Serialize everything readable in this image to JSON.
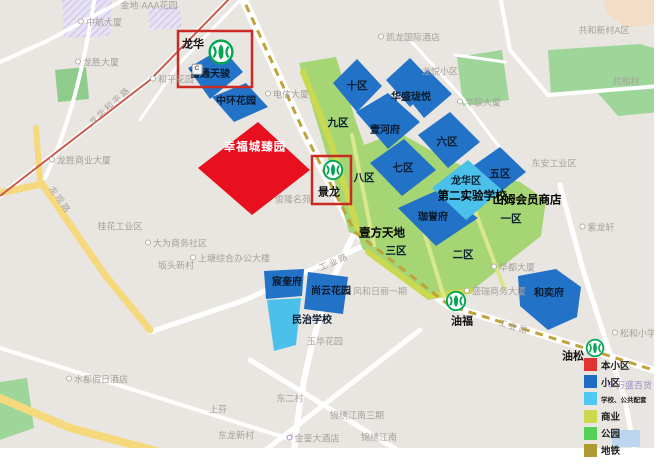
{
  "map": {
    "highlight": {
      "label": "幸福城臻园"
    },
    "stations": [
      {
        "id": "longhua",
        "label": "龙华",
        "boxed": true,
        "exit_badge": "C"
      },
      {
        "id": "jinglong",
        "label": "景龙",
        "boxed": true
      },
      {
        "id": "youfu",
        "label": "油福",
        "boxed": false
      },
      {
        "id": "yousong",
        "label": "油松",
        "boxed": false
      }
    ],
    "zones": [
      {
        "id": "zone10",
        "label": "十区"
      },
      {
        "id": "zone9",
        "label": "九区"
      },
      {
        "id": "zone8",
        "label": "八区"
      },
      {
        "id": "zone7",
        "label": "七区"
      },
      {
        "id": "zone6",
        "label": "六区"
      },
      {
        "id": "zone5",
        "label": "五区"
      },
      {
        "id": "zone3",
        "label": "三区"
      },
      {
        "id": "zone2",
        "label": "二区"
      },
      {
        "id": "zone1",
        "label": "一区"
      }
    ],
    "communities": [
      {
        "id": "futongtianjun",
        "label": "富通天骏"
      },
      {
        "id": "zhonghuan",
        "label": "中环花园"
      },
      {
        "id": "huasheng",
        "label": "华盛珑悦"
      },
      {
        "id": "yihefu",
        "label": "壹河府"
      },
      {
        "id": "jiayufu",
        "label": "珈誉府"
      },
      {
        "id": "shangyun",
        "label": "尚云花园"
      },
      {
        "id": "chenkuifu",
        "label": "宸奎府"
      },
      {
        "id": "heyifu",
        "label": "和奕府"
      }
    ],
    "landmarks": [
      {
        "id": "school2_district",
        "label": "龙华区"
      },
      {
        "id": "school2",
        "label": "第二实验学校"
      },
      {
        "id": "sam",
        "label": "山姆会员商店"
      },
      {
        "id": "yifang",
        "label": "壹方天地"
      },
      {
        "id": "minzhi",
        "label": "民治学校"
      }
    ],
    "road_labels": [
      {
        "id": "gongyelu1",
        "label": "工业路"
      },
      {
        "id": "gongyelu2",
        "label": "工业路"
      },
      {
        "id": "hepinglu",
        "label": "龙华和平路"
      },
      {
        "id": "longguanlu",
        "label": "龙观路"
      }
    ],
    "background_labels": [
      {
        "id": "jindiaaa",
        "label": "金地·AAA花园",
        "poi": false
      },
      {
        "id": "zhonghang",
        "label": "中航大厦",
        "poi": true
      },
      {
        "id": "longsheng_bldg",
        "label": "龙胜大厦",
        "poi": true
      },
      {
        "id": "heping_garden",
        "label": "和平花园",
        "poi": true
      },
      {
        "id": "kailong",
        "label": "凯龙国际酒店",
        "poi": true
      },
      {
        "id": "gonghe_a",
        "label": "共和新村A区",
        "poi": false
      },
      {
        "id": "longyue",
        "label": "龙悦小区",
        "poi": false
      },
      {
        "id": "hualian",
        "label": "华联大厦",
        "poi": true
      },
      {
        "id": "gonghecun",
        "label": "共和村",
        "poi": false
      },
      {
        "id": "dianxin",
        "label": "电信大厦",
        "poi": true
      },
      {
        "id": "longsheng_biz",
        "label": "龙胜商业大厦",
        "poi": true
      },
      {
        "id": "guihua_ind",
        "label": "桂花工业区",
        "poi": false
      },
      {
        "id": "junlong",
        "label": "俊隆名苑",
        "poi": false
      },
      {
        "id": "dawei",
        "label": "大为商务社区",
        "poi": true
      },
      {
        "id": "shangtang",
        "label": "上塘综合办公大楼",
        "poi": true
      },
      {
        "id": "bantou",
        "label": "坂头新村",
        "poi": false
      },
      {
        "id": "dongan",
        "label": "东安工业区",
        "poi": false
      },
      {
        "id": "shengrui",
        "label": "盛瑞商务大厦",
        "poi": true
      },
      {
        "id": "fenghe",
        "label": "风和日丽一期",
        "poi": false
      },
      {
        "id": "yuhua",
        "label": "玉华花园",
        "poi": false
      },
      {
        "id": "shuidu",
        "label": "水都假日酒店",
        "poi": true
      },
      {
        "id": "shangfen",
        "label": "上芬",
        "poi": false
      },
      {
        "id": "dongercun",
        "label": "东二村",
        "poi": false
      },
      {
        "id": "donglong",
        "label": "东龙新村",
        "poi": false
      },
      {
        "id": "jinluan",
        "label": "金銮大酒店",
        "poi": true,
        "pin": "purple"
      },
      {
        "id": "jinxiu3",
        "label": "锦绣江南三期",
        "poi": false
      },
      {
        "id": "jinxiu",
        "label": "锦绣江南",
        "poi": false
      },
      {
        "id": "wansheng",
        "label": "万盛百货",
        "poi": true,
        "pin": "purple",
        "purple": true
      },
      {
        "id": "songhe",
        "label": "松和小学",
        "poi": true
      },
      {
        "id": "zilong",
        "label": "紫龙轩",
        "poi": true
      },
      {
        "id": "huadu",
        "label": "华都大厦",
        "poi": true
      }
    ],
    "legend": {
      "items": [
        {
          "id": "self",
          "label": "本小区",
          "color": "#e23333"
        },
        {
          "id": "community",
          "label": "小区",
          "color": "#1f6cc5"
        },
        {
          "id": "school",
          "label": "学校、公共配套",
          "color": "#4ec9f0",
          "small": true
        },
        {
          "id": "business",
          "label": "商业",
          "color": "#ccd94e"
        },
        {
          "id": "park",
          "label": "公园",
          "color": "#52d058"
        },
        {
          "id": "metro",
          "label": "地铁",
          "color": "#b09a33"
        }
      ]
    }
  }
}
